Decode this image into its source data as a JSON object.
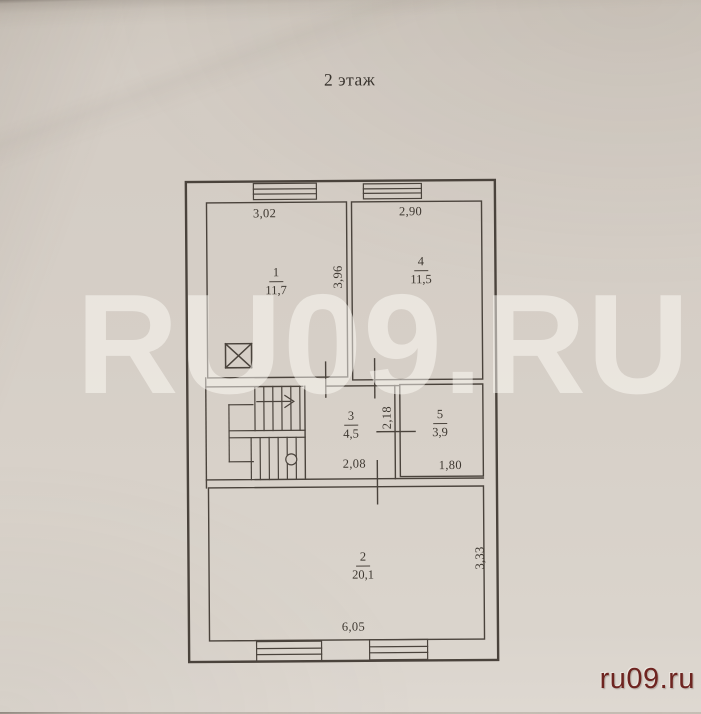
{
  "title": "2 этаж",
  "watermark": "RU09.RU",
  "credit": "ru09.ru",
  "plan": {
    "rooms": [
      {
        "number": "1",
        "area": "11,7"
      },
      {
        "number": "4",
        "area": "11,5"
      },
      {
        "number": "3",
        "area": "4,5"
      },
      {
        "number": "5",
        "area": "3,9"
      },
      {
        "number": "2",
        "area": "20,1"
      }
    ],
    "dims": {
      "w_room1": "3,02",
      "w_room4": "2,90",
      "h_room1": "3,96",
      "h_hall": "2,18",
      "w_hall": "2,08",
      "w_room5": "1,80",
      "w_room2": "6,05",
      "h_room2": "3,33"
    }
  },
  "colors": {
    "paper": "#d4cdc5",
    "ink": "#4a433c",
    "credit_red": "#6e2420"
  }
}
